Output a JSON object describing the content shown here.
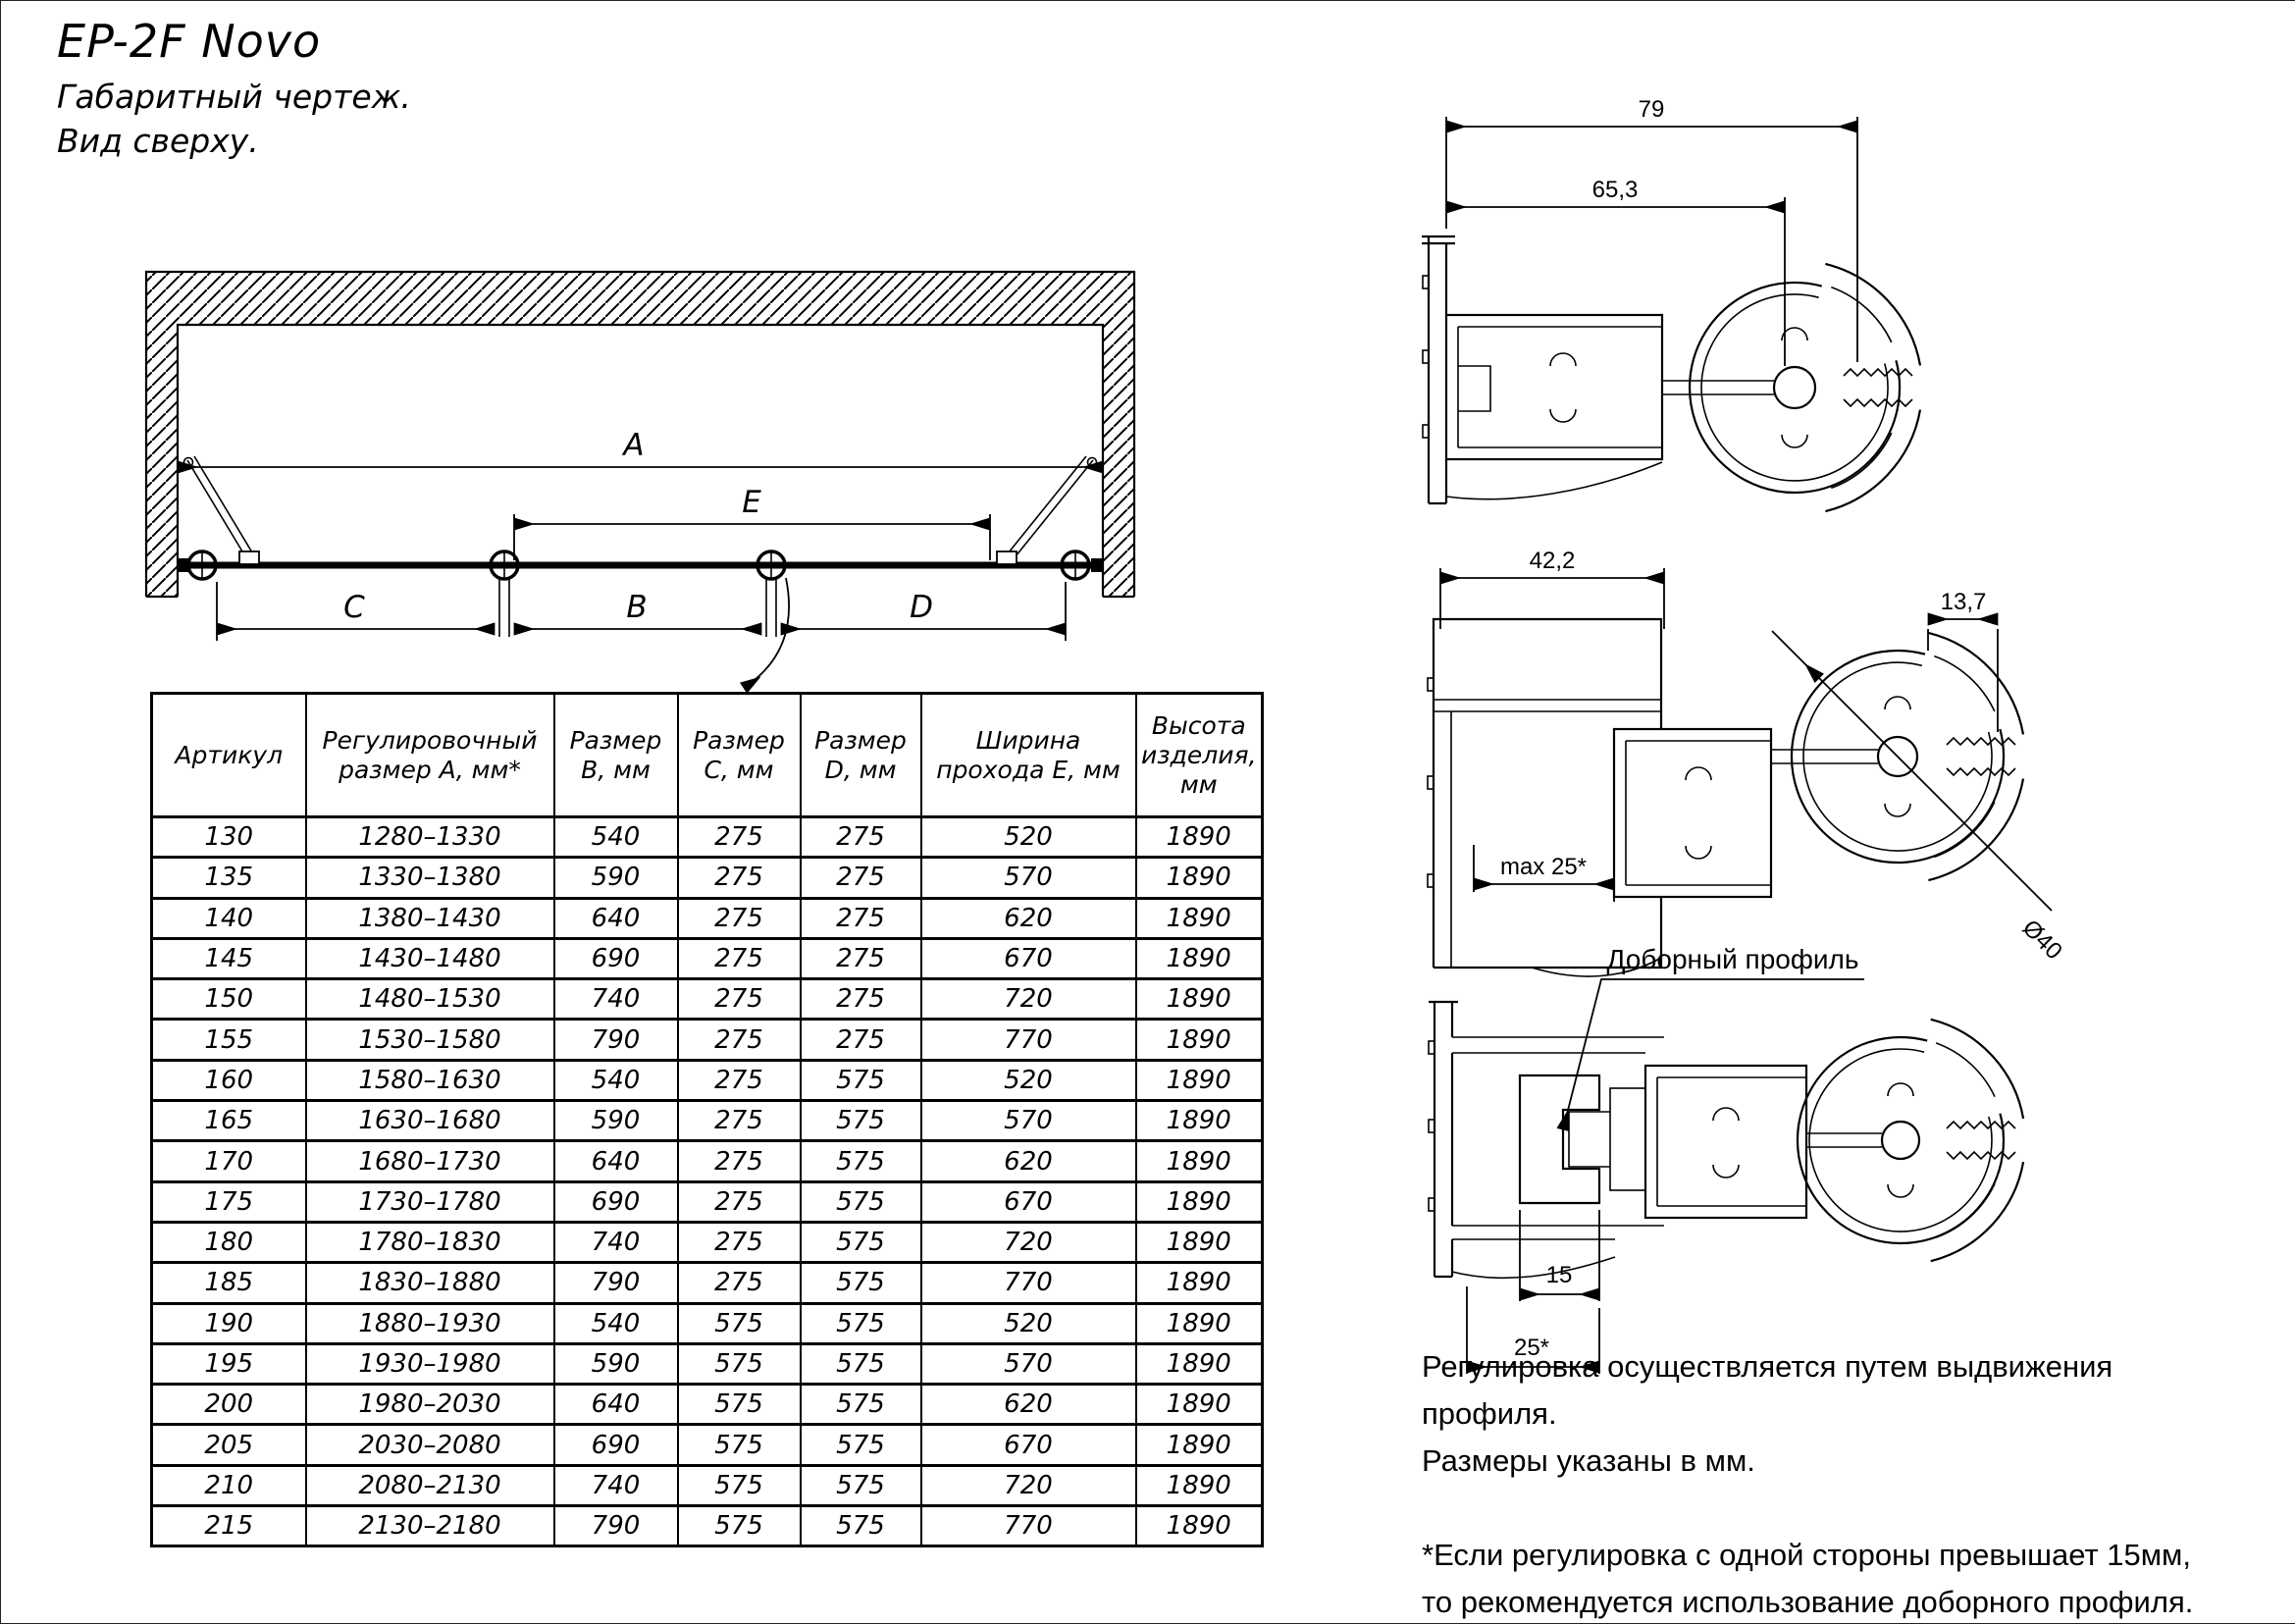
{
  "page": {
    "title": "EP-2F Novo",
    "subtitle": "Габаритный чертеж.",
    "view_label": "Вид сверху."
  },
  "top_view": {
    "dims": {
      "a": "A",
      "b": "B",
      "c": "C",
      "d": "D",
      "e": "E"
    }
  },
  "profiles": {
    "p1": {
      "dim_width_full": "79",
      "dim_width_inner": "65,3"
    },
    "p2": {
      "dim_width": "42,2",
      "dim_gap": "13,7",
      "dim_max": "max 25*",
      "dim_diameter": "Ø40"
    },
    "p3": {
      "callout": "Доборный профиль",
      "dim_insert": "15",
      "dim_adjust": "25*"
    }
  },
  "table": {
    "headers": [
      "Артикул",
      "Регулировочный размер А, мм*",
      "Размер В, мм",
      "Размер С, мм",
      "Размер D, мм",
      "Ширина прохода Е, мм",
      "Высота изделия, мм"
    ],
    "rows": [
      [
        "130",
        "1280–1330",
        "540",
        "275",
        "275",
        "520",
        "1890"
      ],
      [
        "135",
        "1330–1380",
        "590",
        "275",
        "275",
        "570",
        "1890"
      ],
      [
        "140",
        "1380–1430",
        "640",
        "275",
        "275",
        "620",
        "1890"
      ],
      [
        "145",
        "1430–1480",
        "690",
        "275",
        "275",
        "670",
        "1890"
      ],
      [
        "150",
        "1480–1530",
        "740",
        "275",
        "275",
        "720",
        "1890"
      ],
      [
        "155",
        "1530–1580",
        "790",
        "275",
        "275",
        "770",
        "1890"
      ],
      [
        "160",
        "1580–1630",
        "540",
        "275",
        "575",
        "520",
        "1890"
      ],
      [
        "165",
        "1630–1680",
        "590",
        "275",
        "575",
        "570",
        "1890"
      ],
      [
        "170",
        "1680–1730",
        "640",
        "275",
        "575",
        "620",
        "1890"
      ],
      [
        "175",
        "1730–1780",
        "690",
        "275",
        "575",
        "670",
        "1890"
      ],
      [
        "180",
        "1780–1830",
        "740",
        "275",
        "575",
        "720",
        "1890"
      ],
      [
        "185",
        "1830–1880",
        "790",
        "275",
        "575",
        "770",
        "1890"
      ],
      [
        "190",
        "1880–1930",
        "540",
        "575",
        "575",
        "520",
        "1890"
      ],
      [
        "195",
        "1930–1980",
        "590",
        "575",
        "575",
        "570",
        "1890"
      ],
      [
        "200",
        "1980–2030",
        "640",
        "575",
        "575",
        "620",
        "1890"
      ],
      [
        "205",
        "2030–2080",
        "690",
        "575",
        "575",
        "670",
        "1890"
      ],
      [
        "210",
        "2080–2130",
        "740",
        "575",
        "575",
        "720",
        "1890"
      ],
      [
        "215",
        "2130–2180",
        "790",
        "575",
        "575",
        "770",
        "1890"
      ]
    ]
  },
  "notes": {
    "adjust_line1": "Регулировка осуществляется путем выдвижения профиля.",
    "adjust_line2": "Размеры указаны в мм.",
    "footnote_line1": "*Если регулировка с одной стороны превышает 15мм,",
    "footnote_line2": "то рекомендуется использование доборного профиля."
  }
}
